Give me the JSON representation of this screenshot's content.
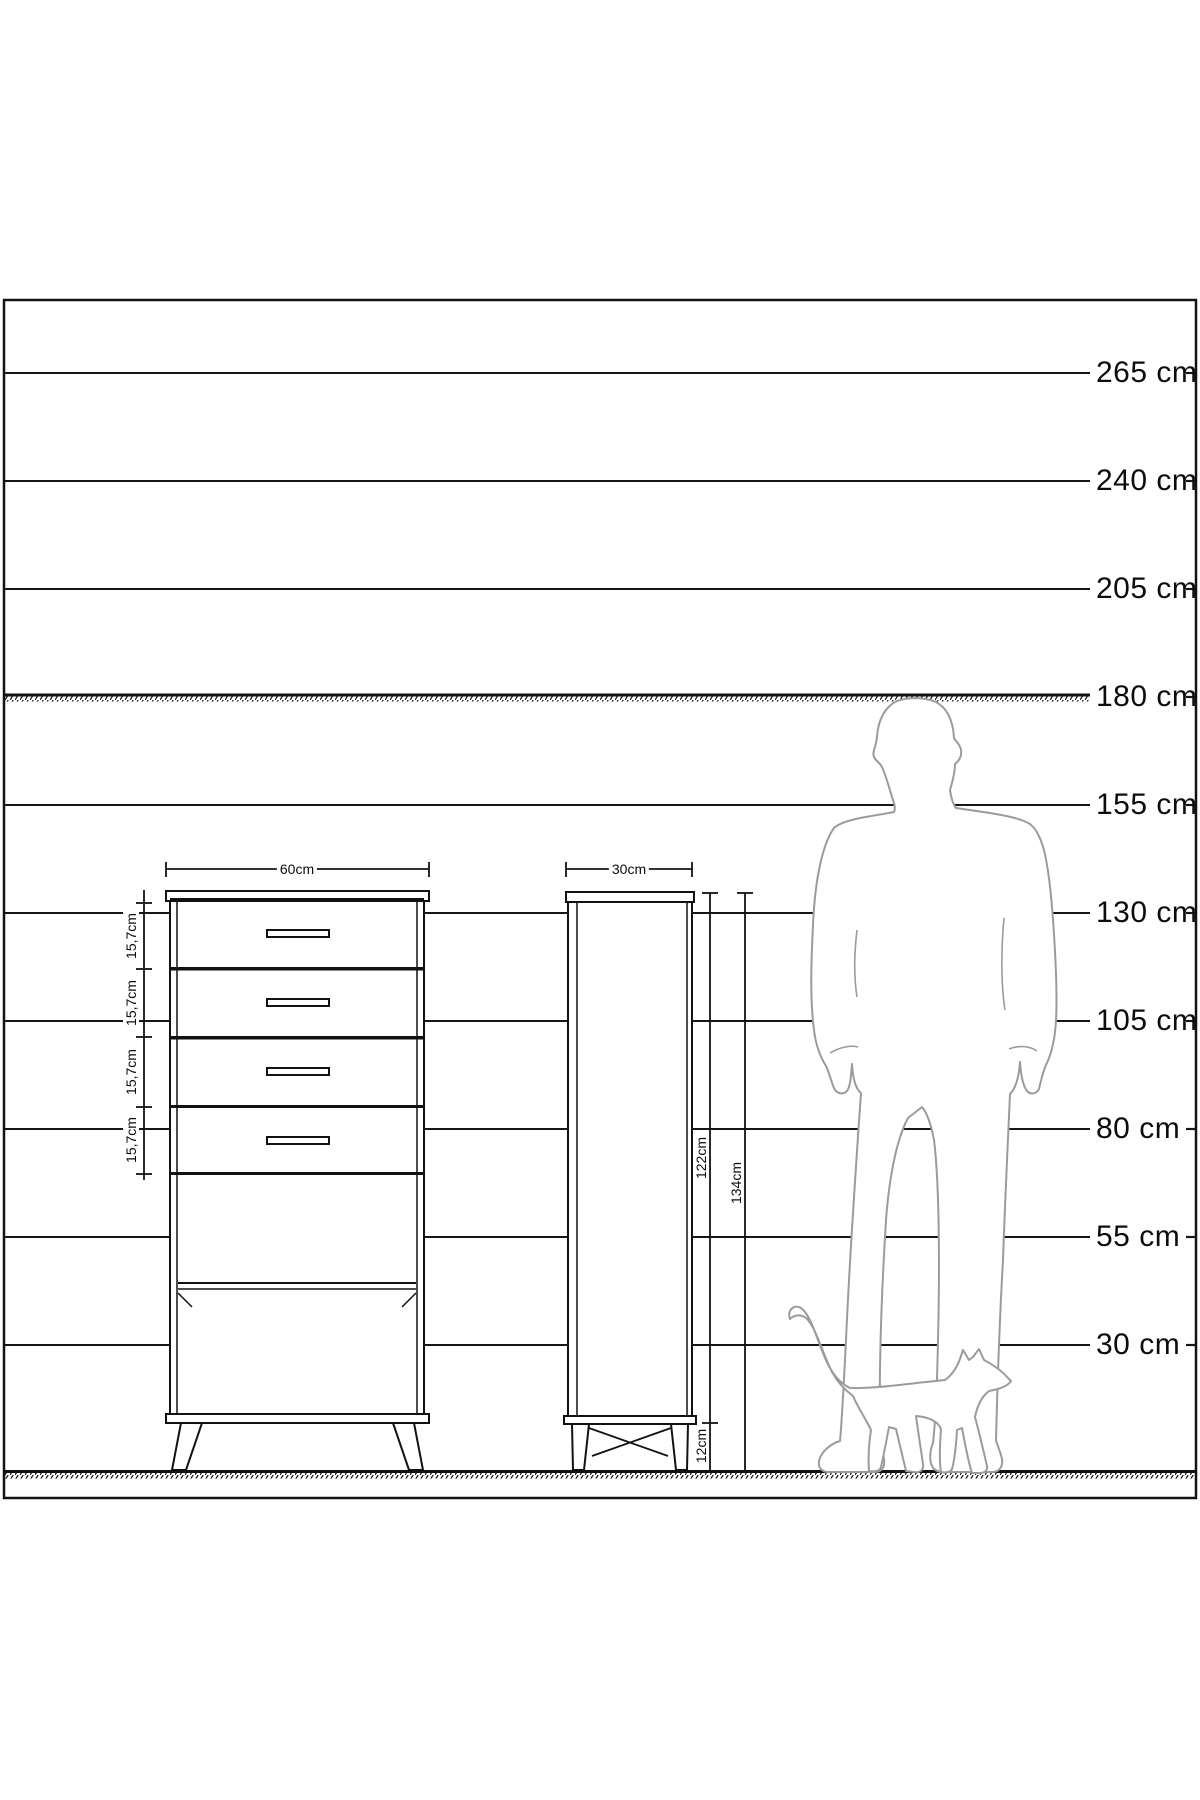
{
  "diagram": {
    "description": "Furniture dimension drawing with height comparison scale",
    "unit": "cm"
  },
  "scale": {
    "labels": [
      "265 cm",
      "240 cm",
      "205 cm",
      "180 cm",
      "155 cm",
      "130 cm",
      "105 cm",
      "80 cm",
      "55 cm",
      "30 cm"
    ]
  },
  "front_view": {
    "width_label": "60cm",
    "drawer_height_labels": [
      "15,7cm",
      "15,7cm",
      "15,7cm",
      "15,7cm"
    ]
  },
  "side_view": {
    "depth_label": "30cm",
    "body_height_label": "122cm",
    "total_height_label": "134cm",
    "leg_height_label": "12cm"
  },
  "figures": {
    "man": "man-silhouette",
    "cat": "cat-silhouette"
  },
  "colors": {
    "ink": "#121212",
    "silhouette": "#9b9b9b",
    "background": "#ffffff"
  }
}
